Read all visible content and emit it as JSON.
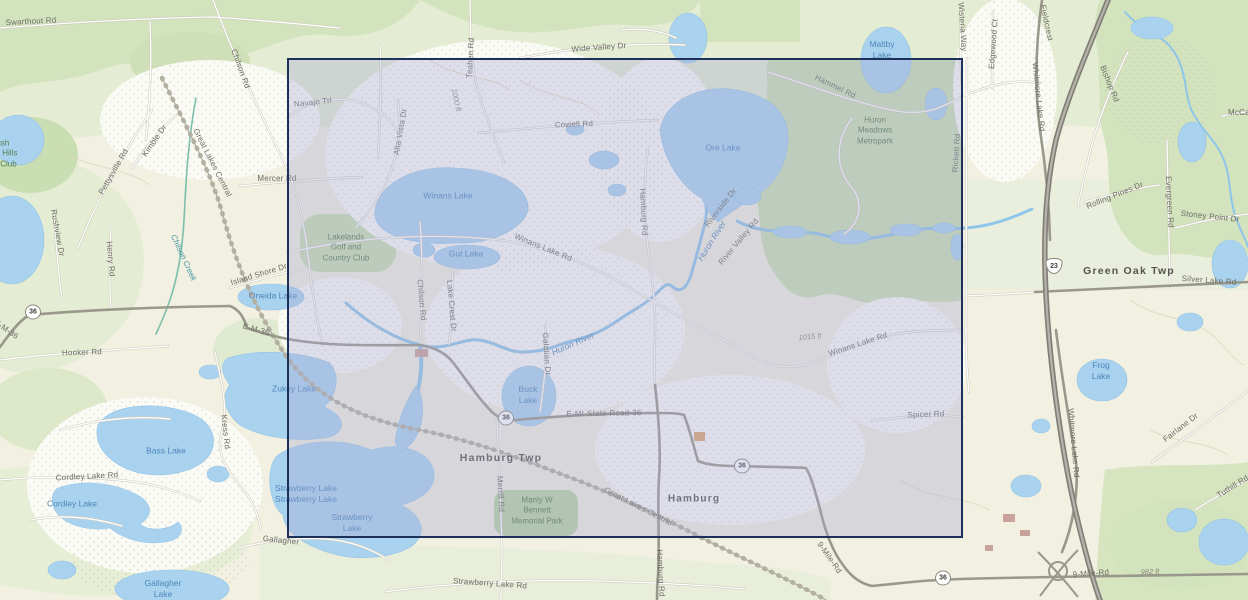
{
  "map": {
    "background_color": "#f1f0e1",
    "palette": {
      "water_fill": "#a9d2ef",
      "forest_fill": "#d3e3bd",
      "metropark_fill": "#cbdfb4",
      "road_major": "#9a978b",
      "highway": "#807e76",
      "selection_border": "#1c3059",
      "selection_fill": "rgba(165,170,210,0.35)"
    },
    "selection_overlay": {
      "x": 287,
      "y": 58,
      "width": 676,
      "height": 480
    },
    "route_shields": [
      {
        "system": "michigan-state",
        "label": "36",
        "x": 33,
        "y": 312
      },
      {
        "system": "michigan-state",
        "label": "36",
        "x": 506,
        "y": 418
      },
      {
        "system": "michigan-state",
        "label": "36",
        "x": 742,
        "y": 466
      },
      {
        "system": "michigan-state",
        "label": "36",
        "x": 943,
        "y": 578
      },
      {
        "system": "us-highway",
        "label": "23",
        "x": 1054,
        "y": 266
      }
    ],
    "labels": [
      {
        "id": "swarthout-rd",
        "t": "Swarthout Rd",
        "x": 31,
        "y": 22,
        "r": -3,
        "c": "road"
      },
      {
        "id": "chilson-rd-north",
        "t": "Chilson Rd",
        "x": 240,
        "y": 69,
        "r": 70,
        "c": "road"
      },
      {
        "id": "kimble-dr",
        "t": "Kimble Dr",
        "x": 155,
        "y": 141,
        "r": -55,
        "c": "road"
      },
      {
        "id": "pettysville-rd",
        "t": "Pettysville Rd",
        "x": 114,
        "y": 172,
        "r": -60,
        "c": "road"
      },
      {
        "id": "great-lakes-central-north",
        "t": "Great Lakes Central",
        "x": 212,
        "y": 163,
        "r": 63,
        "c": "road"
      },
      {
        "id": "mercer-rd",
        "t": "Mercer Rd",
        "x": 277,
        "y": 179,
        "r": 0,
        "c": "road"
      },
      {
        "id": "rush-lake-hills-golf-club",
        "t": "Rush\nLake Hills\nGolf Club",
        "x": 0,
        "y": 154,
        "r": 0,
        "c": "park"
      },
      {
        "id": "rushview-dr",
        "t": "Rushview Dr",
        "x": 57,
        "y": 233,
        "r": 80,
        "c": "road"
      },
      {
        "id": "henry-rd",
        "t": "Henry Rd",
        "x": 110,
        "y": 259,
        "r": 85,
        "c": "road"
      },
      {
        "id": "chilson-creek",
        "t": "Chilson Creek",
        "x": 183,
        "y": 258,
        "r": 65,
        "c": "creek"
      },
      {
        "id": "hooker-rd",
        "t": "Hooker Rd",
        "x": 82,
        "y": 353,
        "r": -2,
        "c": "road"
      },
      {
        "id": "e-m-36-west",
        "t": "E-M-36",
        "x": 6,
        "y": 330,
        "r": 35,
        "c": "road"
      },
      {
        "id": "e-m-36",
        "t": "E-M-36",
        "x": 256,
        "y": 330,
        "r": 15,
        "c": "road"
      },
      {
        "id": "island-shore-dr",
        "t": "Island Shore Dr",
        "x": 259,
        "y": 275,
        "r": -17,
        "c": "road"
      },
      {
        "id": "oneida-lake",
        "t": "Oneida Lake",
        "x": 273,
        "y": 296,
        "r": 0,
        "c": "water"
      },
      {
        "id": "zukey-lake",
        "t": "Zukey Lake",
        "x": 294,
        "y": 389,
        "r": 0,
        "c": "water"
      },
      {
        "id": "navajo-trl",
        "t": "Navajo Trl",
        "x": 313,
        "y": 103,
        "r": -6,
        "c": "road"
      },
      {
        "id": "alta-vista-dr",
        "t": "Alta Vista Dr",
        "x": 401,
        "y": 132,
        "r": -80,
        "c": "road"
      },
      {
        "id": "teahen-rd",
        "t": "Teahen Rd",
        "x": 471,
        "y": 58,
        "r": -87,
        "c": "road"
      },
      {
        "id": "contour-1000-ft",
        "t": "1000 ft",
        "x": 456,
        "y": 100,
        "r": 78,
        "c": "elev"
      },
      {
        "id": "wide-valley-dr",
        "t": "Wide Valley Dr",
        "x": 599,
        "y": 48,
        "r": -4,
        "c": "road"
      },
      {
        "id": "cowell-rd",
        "t": "Cowell Rd",
        "x": 574,
        "y": 125,
        "r": -2,
        "c": "road"
      },
      {
        "id": "winans-lake",
        "t": "Winans Lake",
        "x": 448,
        "y": 196,
        "r": 0,
        "c": "water"
      },
      {
        "id": "lakelands-golf-country-club",
        "t": "Lakelands\nGolf and\nCountry Club",
        "x": 346,
        "y": 248,
        "r": 0,
        "c": "park"
      },
      {
        "id": "gut-lake",
        "t": "Gut Lake",
        "x": 466,
        "y": 254,
        "r": 0,
        "c": "water"
      },
      {
        "id": "winans-lake-rd-west",
        "t": "Winans Lake Rd",
        "x": 543,
        "y": 248,
        "r": 22,
        "c": "road"
      },
      {
        "id": "chilson-rd-south",
        "t": "Chilson Rd",
        "x": 421,
        "y": 300,
        "r": 85,
        "c": "road"
      },
      {
        "id": "lake-crest-dr",
        "t": "Lake Crest Dr",
        "x": 451,
        "y": 306,
        "r": 85,
        "c": "road"
      },
      {
        "id": "hamburg-rd-north",
        "t": "Hamburg Rd",
        "x": 643,
        "y": 212,
        "r": 87,
        "c": "road"
      },
      {
        "id": "riverside-dr",
        "t": "Riverside Dr",
        "x": 721,
        "y": 208,
        "r": -52,
        "c": "road"
      },
      {
        "id": "huron-river-northeast",
        "t": "Huron River",
        "x": 712,
        "y": 241,
        "r": -58,
        "c": "river"
      },
      {
        "id": "river-valley-rd",
        "t": "River Valley Rd",
        "x": 739,
        "y": 242,
        "r": -50,
        "c": "road"
      },
      {
        "id": "ore-lake",
        "t": "Ore Lake",
        "x": 723,
        "y": 148,
        "r": 0,
        "c": "water"
      },
      {
        "id": "hammel-rd",
        "t": "Hammel Rd",
        "x": 835,
        "y": 87,
        "r": 26,
        "c": "road"
      },
      {
        "id": "huron-meadows-metropark",
        "t": "Huron\nMeadows\nMetropark",
        "x": 875,
        "y": 131,
        "r": 0,
        "c": "park"
      },
      {
        "id": "maltby-lake",
        "t": "Maltby\nLake",
        "x": 882,
        "y": 50,
        "r": 0,
        "c": "water"
      },
      {
        "id": "rickett-rd",
        "t": "Rickett Rd",
        "x": 957,
        "y": 153,
        "r": -86,
        "c": "road"
      },
      {
        "id": "wisteria-way",
        "t": "Wisteria Way",
        "x": 962,
        "y": 27,
        "r": 86,
        "c": "road"
      },
      {
        "id": "edgewood-ct",
        "t": "Edgewood Ct",
        "x": 994,
        "y": 44,
        "r": -86,
        "c": "road"
      },
      {
        "id": "fieldcrest",
        "t": "Fieldcrest",
        "x": 1046,
        "y": 23,
        "r": 78,
        "c": "road"
      },
      {
        "id": "whitmore-lake-rd-north",
        "t": "Whitmore Lake Rd",
        "x": 1038,
        "y": 97,
        "r": 84,
        "c": "road"
      },
      {
        "id": "bishop-rd",
        "t": "Bishop Rd",
        "x": 1109,
        "y": 84,
        "r": 68,
        "c": "road"
      },
      {
        "id": "mccabe-rd",
        "t": "McCabe Rd",
        "x": 1250,
        "y": 113,
        "r": 0,
        "c": "road"
      },
      {
        "id": "rolling-pines-dr",
        "t": "Rolling Pines Dr",
        "x": 1115,
        "y": 196,
        "r": -22,
        "c": "road"
      },
      {
        "id": "evergreen-rd",
        "t": "Evergreen Rd",
        "x": 1169,
        "y": 202,
        "r": 87,
        "c": "road"
      },
      {
        "id": "stoney-point-dr",
        "t": "Stoney Point Dr",
        "x": 1210,
        "y": 217,
        "r": 6,
        "c": "road"
      },
      {
        "id": "green-oak-twp",
        "t": "Green Oak Twp",
        "x": 1129,
        "y": 272,
        "r": 0,
        "c": "town"
      },
      {
        "id": "silver-lake-rd",
        "t": "Silver Lake Rd",
        "x": 1209,
        "y": 281,
        "r": 4,
        "c": "road"
      },
      {
        "id": "frog-lake",
        "t": "Frog\nLake",
        "x": 1101,
        "y": 371,
        "r": 0,
        "c": "water"
      },
      {
        "id": "winans-lake-rd-east",
        "t": "Winans Lake Rd",
        "x": 858,
        "y": 345,
        "r": -18,
        "c": "road"
      },
      {
        "id": "contour-1015-ft",
        "t": "1015 ft",
        "x": 810,
        "y": 337,
        "r": -5,
        "c": "elev"
      },
      {
        "id": "spicer-rd",
        "t": "Spicer Rd",
        "x": 926,
        "y": 415,
        "r": -2,
        "c": "road"
      },
      {
        "id": "huron-river-central",
        "t": "Huron River",
        "x": 573,
        "y": 344,
        "r": -24,
        "c": "river"
      },
      {
        "id": "buck-lake",
        "t": "Buck\nLake",
        "x": 528,
        "y": 395,
        "r": 0,
        "c": "water"
      },
      {
        "id": "galatian-dr",
        "t": "Galatian Dr",
        "x": 546,
        "y": 354,
        "r": 86,
        "c": "road"
      },
      {
        "id": "e-mi-state-road-36",
        "t": "E-MI-State-Road-36",
        "x": 604,
        "y": 414,
        "r": -1,
        "c": "road"
      },
      {
        "id": "hamburg-twp",
        "t": "Hamburg Twp",
        "x": 501,
        "y": 459,
        "r": 0,
        "c": "town"
      },
      {
        "id": "merrill-rd",
        "t": "Merrill Rd",
        "x": 500,
        "y": 494,
        "r": 87,
        "c": "road"
      },
      {
        "id": "manly-w-bennett-memorial-park",
        "t": "Manly W\nBennett\nMemorial Park",
        "x": 537,
        "y": 511,
        "r": 0,
        "c": "park"
      },
      {
        "id": "hamburg",
        "t": "Hamburg",
        "x": 694,
        "y": 499,
        "r": 0,
        "c": "city"
      },
      {
        "id": "great-lakes-central-south",
        "t": "Great Lakes Central",
        "x": 638,
        "y": 507,
        "r": 27,
        "c": "road"
      },
      {
        "id": "nine-mile-rd-diagonal",
        "t": "9-Mile-Rd",
        "x": 829,
        "y": 558,
        "r": 55,
        "c": "road"
      },
      {
        "id": "hamburg-rd-south",
        "t": "Hamburg Rd",
        "x": 660,
        "y": 573,
        "r": 87,
        "c": "road"
      },
      {
        "id": "strawberry-lake-rd",
        "t": "Strawberry Lake Rd",
        "x": 490,
        "y": 584,
        "r": 4,
        "c": "road"
      },
      {
        "id": "strawberry-lake-names",
        "t": "Strawberry Lake\nStrawberry Lake",
        "x": 306,
        "y": 494,
        "r": 0,
        "c": "water"
      },
      {
        "id": "strawberry-lake",
        "t": "Strawberry\nLake",
        "x": 352,
        "y": 523,
        "r": 0,
        "c": "water"
      },
      {
        "id": "gallagher",
        "t": "Gallagher",
        "x": 281,
        "y": 541,
        "r": 6,
        "c": "road"
      },
      {
        "id": "gallagher-lake",
        "t": "Gallagher\nLake",
        "x": 163,
        "y": 589,
        "r": 0,
        "c": "water"
      },
      {
        "id": "cordley-lake-rd",
        "t": "Cordley Lake Rd",
        "x": 87,
        "y": 477,
        "r": -3,
        "c": "road"
      },
      {
        "id": "cordley-lake",
        "t": "Cordley Lake",
        "x": 72,
        "y": 504,
        "r": 0,
        "c": "water"
      },
      {
        "id": "bass-lake",
        "t": "Bass Lake",
        "x": 166,
        "y": 451,
        "r": 0,
        "c": "water"
      },
      {
        "id": "kress-rd",
        "t": "Kress Rd",
        "x": 225,
        "y": 432,
        "r": 84,
        "c": "road"
      },
      {
        "id": "nine-mile-rd",
        "t": "9-Mile-Rd",
        "x": 1091,
        "y": 574,
        "r": -4,
        "c": "road"
      },
      {
        "id": "contour-982-ft",
        "t": "982 ft",
        "x": 1150,
        "y": 572,
        "r": -3,
        "c": "elev"
      },
      {
        "id": "fairlane-dr",
        "t": "Fairlane Dr",
        "x": 1181,
        "y": 428,
        "r": -38,
        "c": "road"
      },
      {
        "id": "tuthill-rd",
        "t": "Tuthill Rd",
        "x": 1233,
        "y": 487,
        "r": -32,
        "c": "road"
      },
      {
        "id": "whitmore-lake-rd-south",
        "t": "Whitmore Lake Rd",
        "x": 1073,
        "y": 443,
        "r": 85,
        "c": "road"
      }
    ]
  }
}
